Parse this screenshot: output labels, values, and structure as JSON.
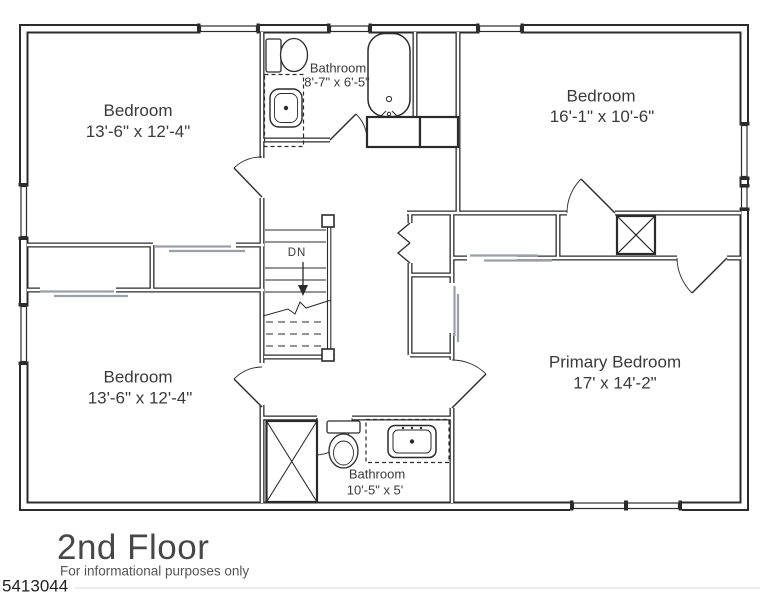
{
  "floor_plan": {
    "title": "2nd Floor",
    "subtitle": "For informational purposes only",
    "reference_number": "5413044",
    "stair_label": "DN",
    "rooms": {
      "bedroom_top_left": {
        "name": "Bedroom",
        "dims": "13'-6\" x 12'-4\""
      },
      "bathroom_top": {
        "name": "Bathroom",
        "dims": "8'-7\" x 6'-5\""
      },
      "bedroom_top_right": {
        "name": "Bedroom",
        "dims": "16'-1\" x 10'-6\""
      },
      "bedroom_bottom_left": {
        "name": "Bedroom",
        "dims": "13'-6\" x 12'-4\""
      },
      "bathroom_bottom": {
        "name": "Bathroom",
        "dims": "10'-5\" x 5'"
      },
      "primary_bedroom": {
        "name": "Primary Bedroom",
        "dims": "17' x 14'-2\""
      }
    },
    "colors": {
      "wall": "#2b2b2b",
      "label_text": "#3a3a3a",
      "title_text": "#474747",
      "pocket_door": "#9aa0a6"
    }
  }
}
